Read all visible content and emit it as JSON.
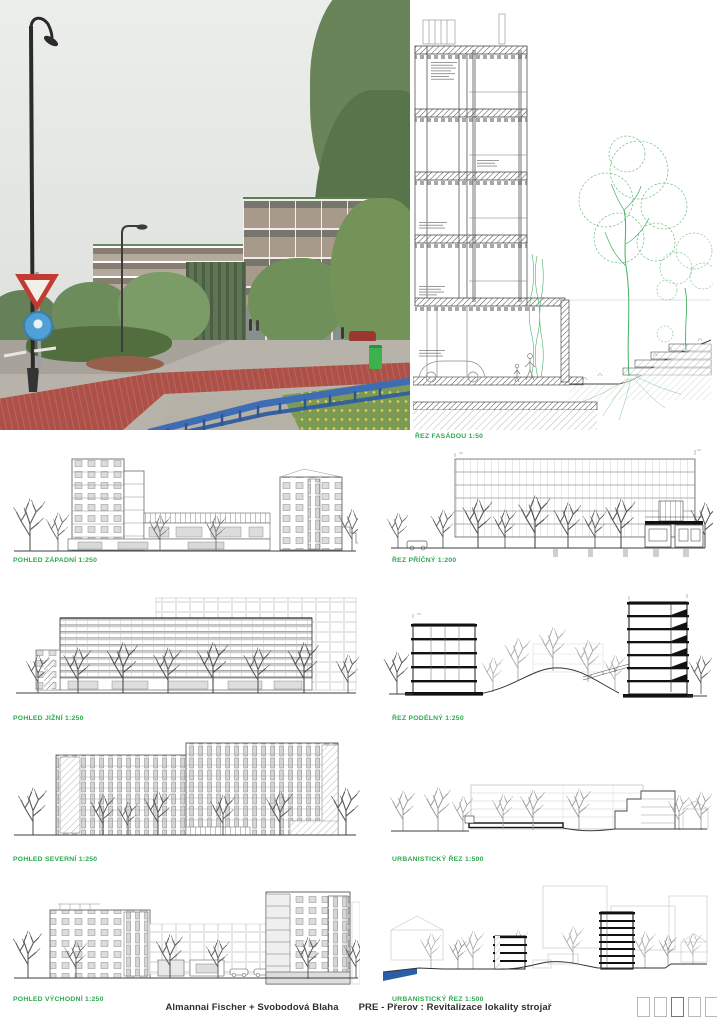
{
  "footer": {
    "authors": "Almannai Fischer + Svobodová Blaha",
    "project": "PRE - Přerov : Revitalizace lokality strojař"
  },
  "panel_labels": {
    "facade_section": "ŘEZ FASÁDOU 1:50",
    "west_elevation": "POHLED ZÁPADNÍ 1:250",
    "cross_section": "ŘEZ PŘÍČNÝ 1:200",
    "south_elevation": "POHLED JIŽNÍ 1:250",
    "long_section": "ŘEZ PODÉLNÝ 1:250",
    "north_elevation": "POHLED SEVERNÍ 1:250",
    "urban_section_a": "URBANISTICKÝ ŘEZ 1:500",
    "east_elevation": "POHLED VÝCHODNÍ 1:250",
    "urban_section_b": "URBANISTICKÝ ŘEZ 1:500"
  },
  "colors": {
    "label_green": "#2fa851",
    "drawing_tree_green": "#46b065",
    "bike_path_red": "#ad5148",
    "railing_blue": "#3f6db5",
    "water_blue": "#2a5fa8"
  },
  "board_indicator": {
    "total_boxes": 5,
    "highlighted_box": 3
  }
}
